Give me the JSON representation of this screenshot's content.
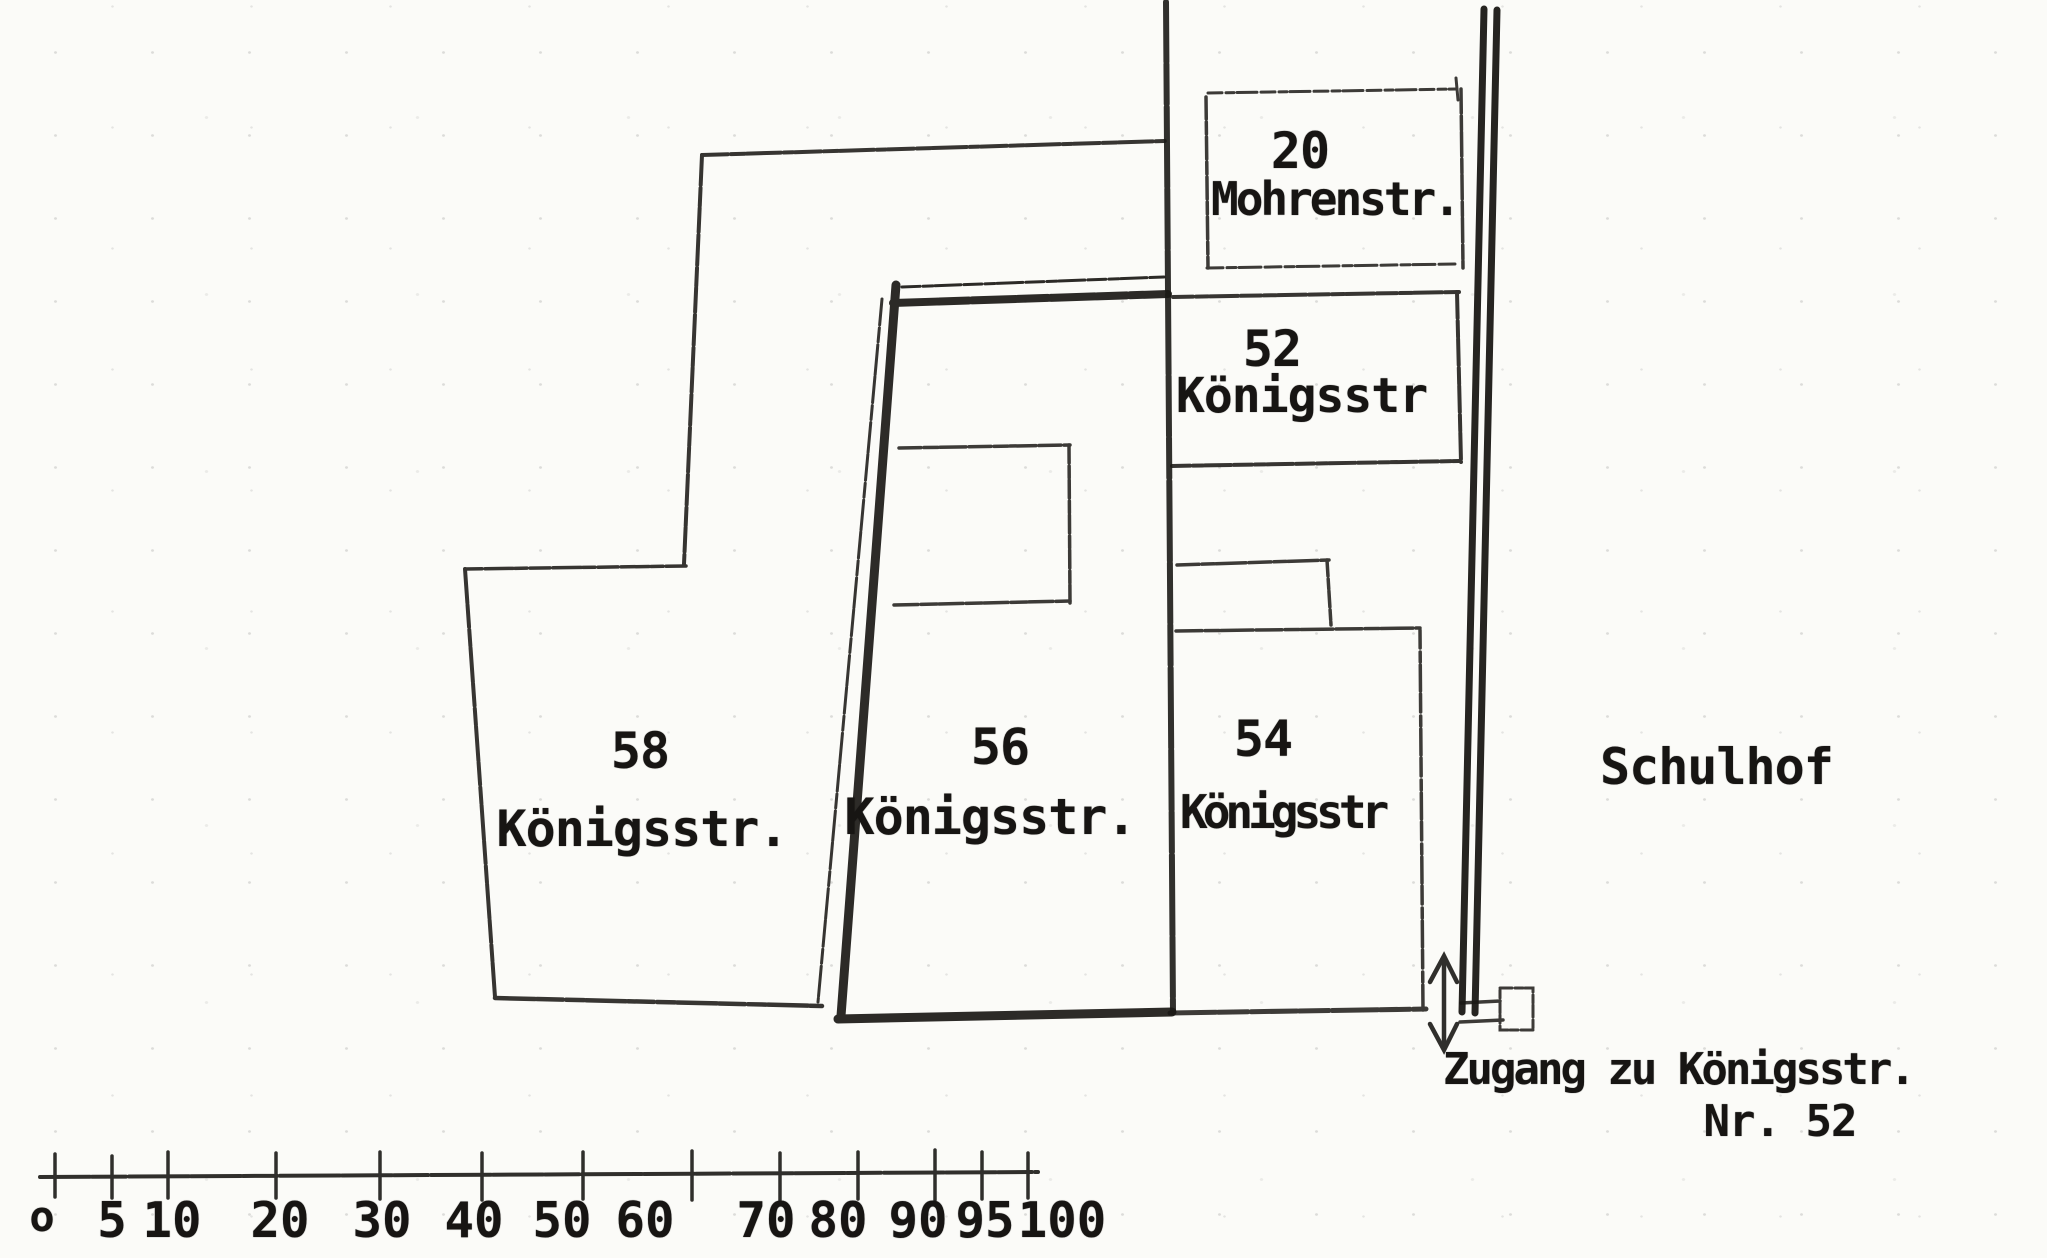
{
  "plots": {
    "mohrenstr20": {
      "number": "20",
      "street": "Mohrenstr."
    },
    "koenigsstr52": {
      "number": "52",
      "street": "Königsstr"
    },
    "koenigsstr58": {
      "number": "58",
      "street": "Königsstr."
    },
    "koenigsstr56": {
      "number": "56",
      "street": "Königsstr."
    },
    "koenigsstr54": {
      "number": "54",
      "street": "Königsstr"
    }
  },
  "labels": {
    "schulhof": "Schulhof",
    "zugang_line1": "Zugang zu Königsstr.",
    "zugang_line2": "Nr. 52"
  },
  "scale": {
    "labels": [
      "o",
      "5",
      "10",
      "20",
      "30",
      "40",
      "50",
      "60",
      "70",
      "80",
      "90",
      "95",
      "100"
    ]
  },
  "icons": {
    "arrow": "double-headed-vertical-arrow",
    "gate": "gate-opening-symbol"
  },
  "colors": {
    "ink": "#1b1916",
    "paper": "#fbfbf8"
  }
}
